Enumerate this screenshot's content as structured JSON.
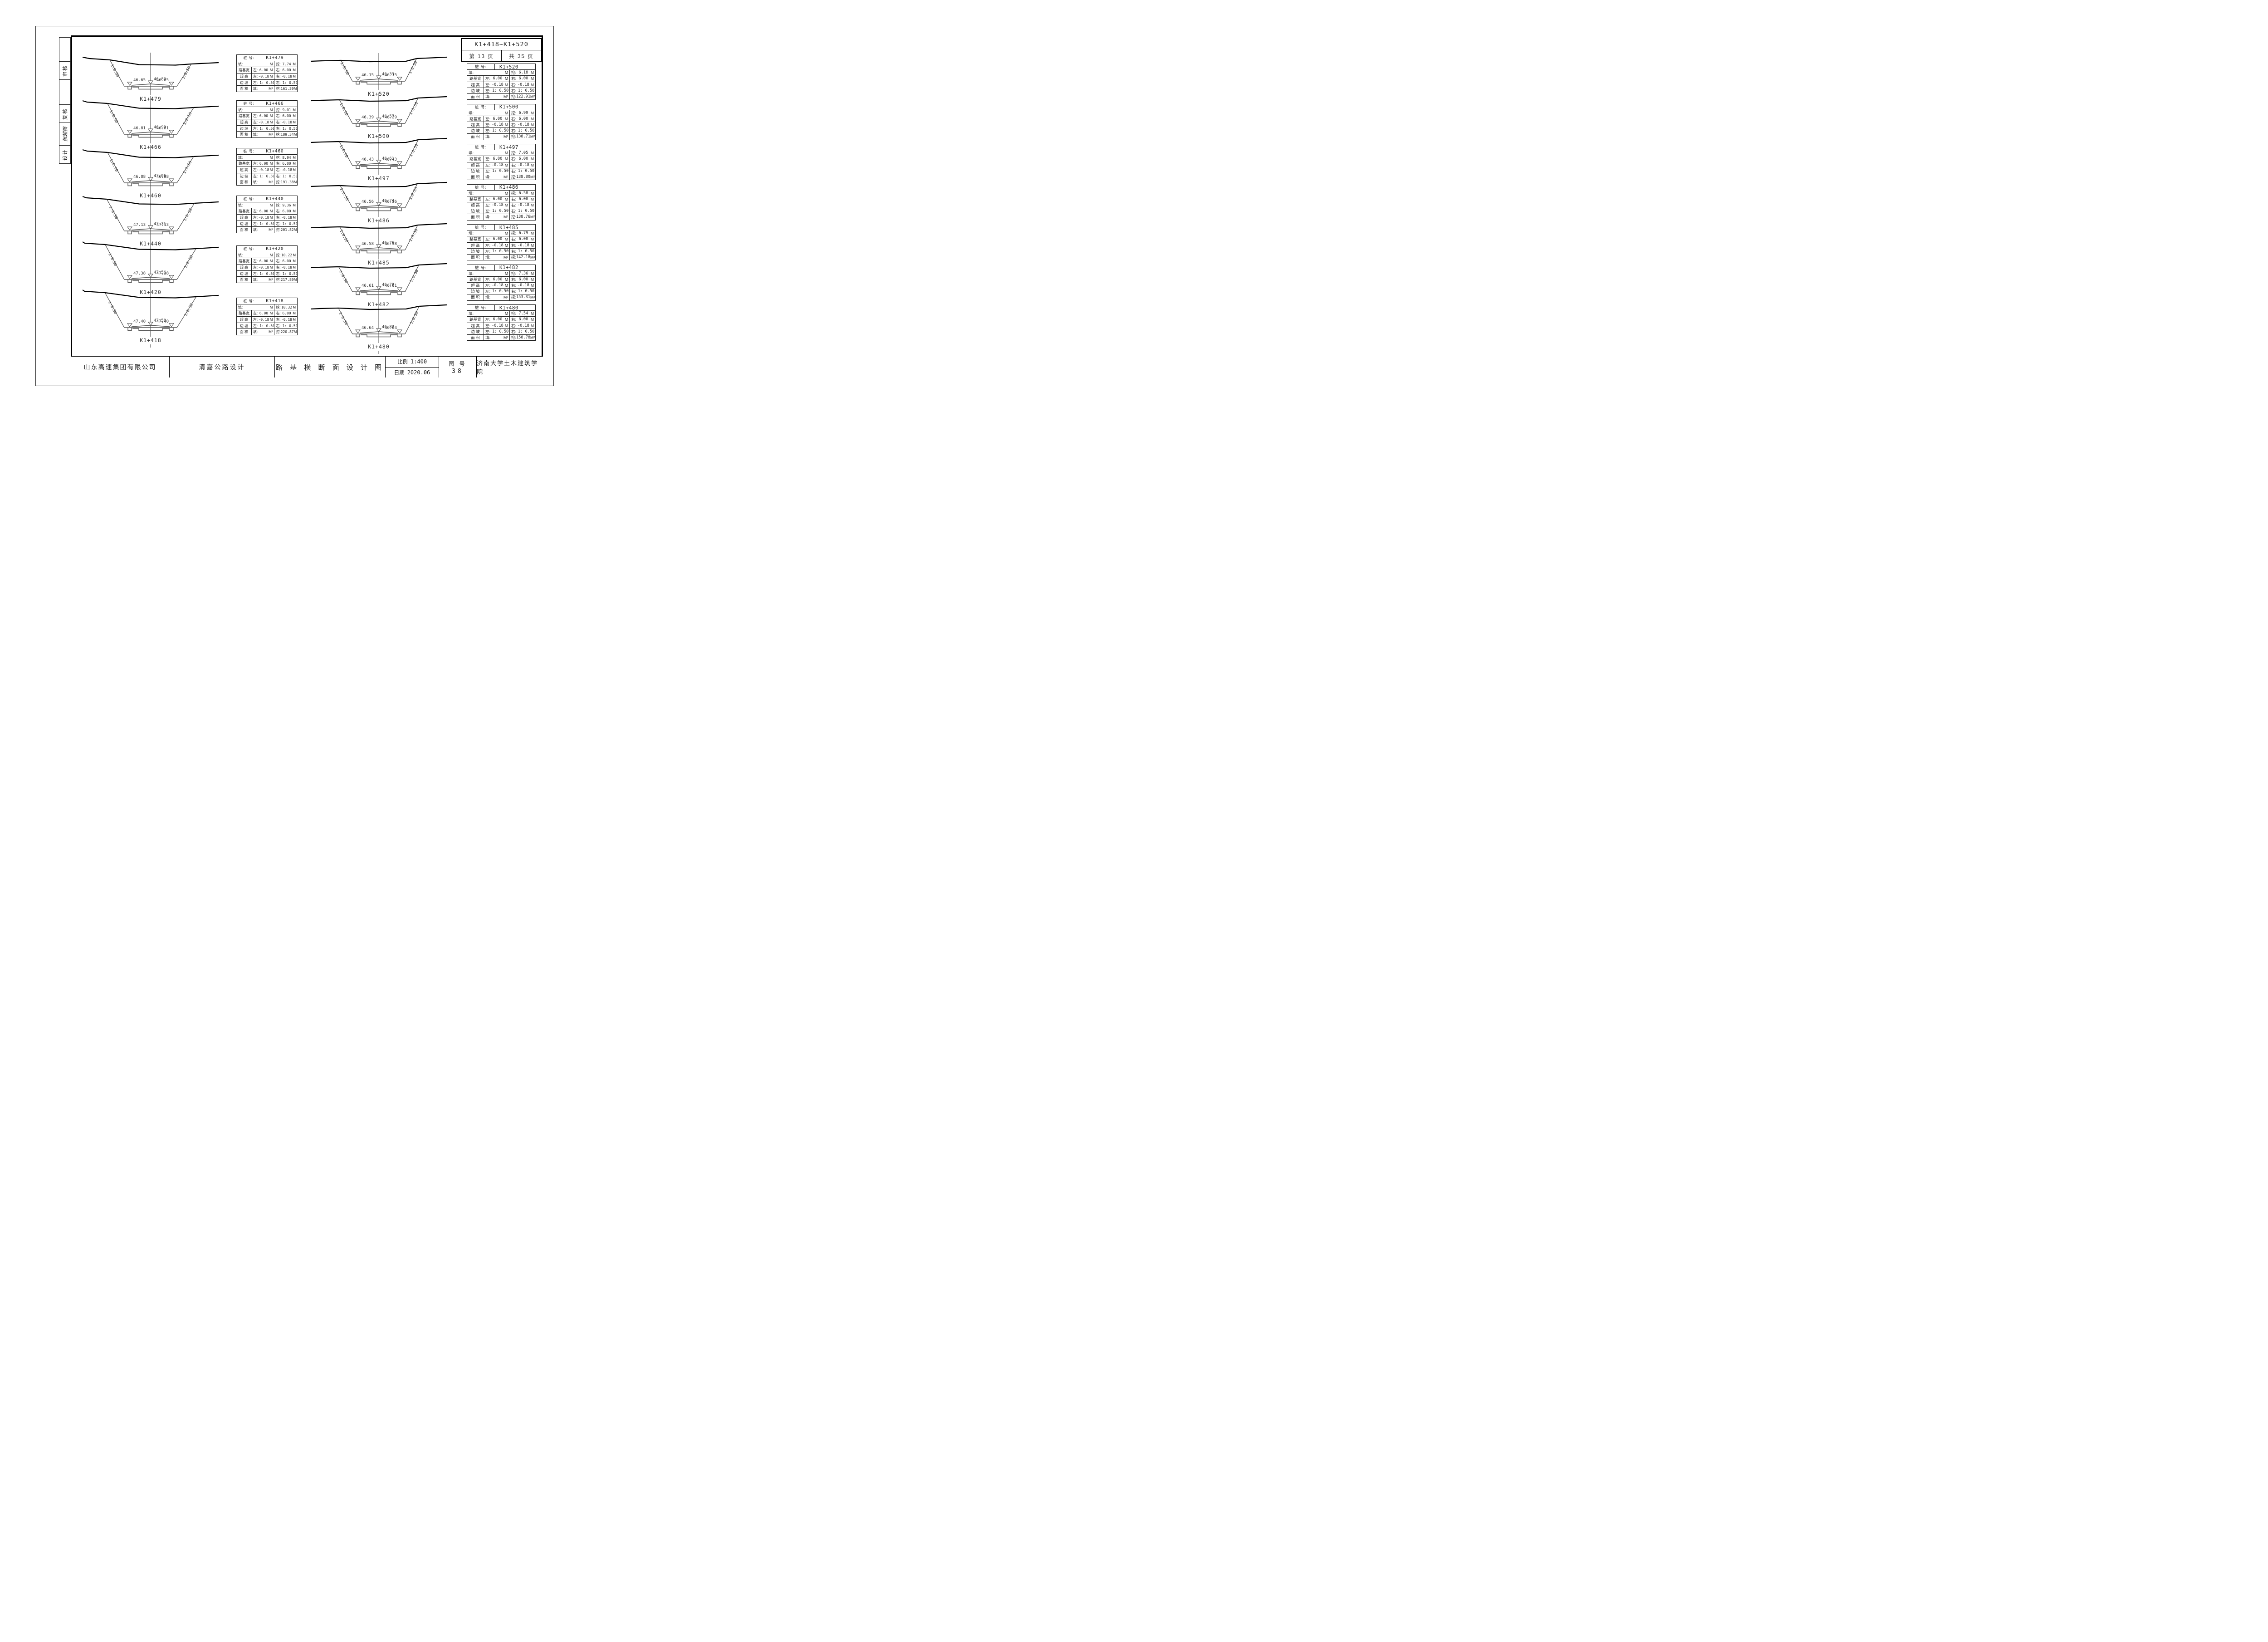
{
  "header": {
    "range": "K1+418~K1+520",
    "page_label": "第 13 页",
    "total_label": "共 35 页"
  },
  "sidebar": {
    "cells": [
      "",
      "审核",
      "",
      "复核",
      "张超强",
      "设计"
    ]
  },
  "table_labels": {
    "station": "桩 号:",
    "fill": "填:",
    "cut": "挖:",
    "roadbed_width": "路基宽",
    "superelevation": "超 高",
    "side_slope": "边 坡",
    "area": "面 积",
    "left": "左:",
    "right": "右:",
    "unit_m": "M",
    "unit_m2": "M²"
  },
  "section_labels": {
    "slope": "1:0.50"
  },
  "columns": {
    "left": [
      {
        "station": "K1+479",
        "cut": "7.74",
        "rb_l": "6.00",
        "rb_r": "6.00",
        "se_l": "-0.18",
        "se_r": "-0.18",
        "sl_l": "1: 0.50",
        "sl_r": "1: 0.50",
        "area_cut": "161.39",
        "elev_l": "46.65",
        "elev_c": "46.83",
        "elev_r": "46.65"
      },
      {
        "station": "K1+466",
        "cut": "9.01",
        "rb_l": "6.00",
        "rb_r": "6.00",
        "se_l": "-0.18",
        "se_r": "-0.18",
        "sl_l": "1: 0.50",
        "sl_r": "1: 0.50",
        "area_cut": "189.34",
        "elev_l": "46.81",
        "elev_c": "46.99",
        "elev_r": "46.81"
      },
      {
        "station": "K1+460",
        "cut": "8.94",
        "rb_l": "6.00",
        "rb_r": "6.00",
        "se_l": "-0.18",
        "se_r": "-0.18",
        "sl_l": "1: 0.50",
        "sl_r": "1: 0.50",
        "area_cut": "191.38",
        "elev_l": "46.88",
        "elev_c": "47.06",
        "elev_r": "46.88"
      },
      {
        "station": "K1+440",
        "cut": "9.36",
        "rb_l": "6.00",
        "rb_r": "6.00",
        "se_l": "-0.18",
        "se_r": "-0.18",
        "sl_l": "1: 0.50",
        "sl_r": "1: 0.50",
        "area_cut": "201.82",
        "elev_l": "47.13",
        "elev_c": "47.31",
        "elev_r": "47.13"
      },
      {
        "station": "K1+420",
        "cut": "10.22",
        "rb_l": "6.00",
        "rb_r": "6.00",
        "se_l": "-0.18",
        "se_r": "-0.18",
        "sl_l": "1: 0.50",
        "sl_r": "1: 0.50",
        "area_cut": "217.89",
        "elev_l": "47.38",
        "elev_c": "47.56",
        "elev_r": "47.38"
      },
      {
        "station": "K1+418",
        "cut": "10.32",
        "rb_l": "6.00",
        "rb_r": "6.00",
        "se_l": "-0.18",
        "se_r": "-0.18",
        "sl_l": "1: 0.50",
        "sl_r": "1: 0.50",
        "area_cut": "220.87",
        "elev_l": "47.40",
        "elev_c": "47.58",
        "elev_r": "47.40"
      }
    ],
    "right": [
      {
        "station": "K1+520",
        "cut": "6.18",
        "rb_l": "6.00",
        "rb_r": "6.00",
        "se_l": "-0.18",
        "se_r": "-0.18",
        "sl_l": "1: 0.50",
        "sl_r": "1: 0.50",
        "area_cut": "122.91",
        "elev_l": "46.15",
        "elev_c": "46.33",
        "elev_r": "46.15"
      },
      {
        "station": "K1+500",
        "cut": "6.99",
        "rb_l": "6.00",
        "rb_r": "6.00",
        "se_l": "-0.18",
        "se_r": "-0.18",
        "sl_l": "1: 0.50",
        "sl_r": "1: 0.50",
        "area_cut": "138.71",
        "elev_l": "46.39",
        "elev_c": "46.57",
        "elev_r": "46.39"
      },
      {
        "station": "K1+497",
        "cut": "7.05",
        "rb_l": "6.00",
        "rb_r": "6.00",
        "se_l": "-0.18",
        "se_r": "-0.18",
        "sl_l": "1: 0.50",
        "sl_r": "1: 0.50",
        "area_cut": "138.80",
        "elev_l": "46.43",
        "elev_c": "46.61",
        "elev_r": "46.43"
      },
      {
        "station": "K1+486",
        "cut": "6.58",
        "rb_l": "6.00",
        "rb_r": "6.00",
        "se_l": "-0.18",
        "se_r": "-0.18",
        "sl_l": "1: 0.50",
        "sl_r": "1: 0.50",
        "area_cut": "138.76",
        "elev_l": "46.56",
        "elev_c": "46.74",
        "elev_r": "46.56"
      },
      {
        "station": "K1+485",
        "cut": "6.79",
        "rb_l": "6.00",
        "rb_r": "6.00",
        "se_l": "-0.18",
        "se_r": "-0.18",
        "sl_l": "1: 0.50",
        "sl_r": "1: 0.50",
        "area_cut": "142.18",
        "elev_l": "46.58",
        "elev_c": "46.76",
        "elev_r": "46.58"
      },
      {
        "station": "K1+482",
        "cut": "7.36",
        "rb_l": "6.00",
        "rb_r": "6.00",
        "se_l": "-0.18",
        "se_r": "-0.18",
        "sl_l": "1: 0.50",
        "sl_r": "1: 0.50",
        "area_cut": "153.31",
        "elev_l": "46.61",
        "elev_c": "46.79",
        "elev_r": "46.61"
      },
      {
        "station": "K1+480",
        "cut": "7.54",
        "rb_l": "6.00",
        "rb_r": "6.00",
        "se_l": "-0.18",
        "se_r": "-0.18",
        "sl_l": "1: 0.50",
        "sl_r": "1: 0.50",
        "area_cut": "158.78",
        "elev_l": "46.64",
        "elev_c": "46.82",
        "elev_r": "46.64"
      }
    ]
  },
  "titleblock": {
    "company": "山东高速集团有限公司",
    "project": "清嘉公路设计",
    "drawing_title": "路 基 横 断 面 设 计 图",
    "scale_label": "比例",
    "scale_value": "1:400",
    "date_label": "日期",
    "date_value": "2020.06",
    "fig_label": "图 号",
    "fig_value": "38",
    "institute": "济南大学土木建筑学院"
  }
}
